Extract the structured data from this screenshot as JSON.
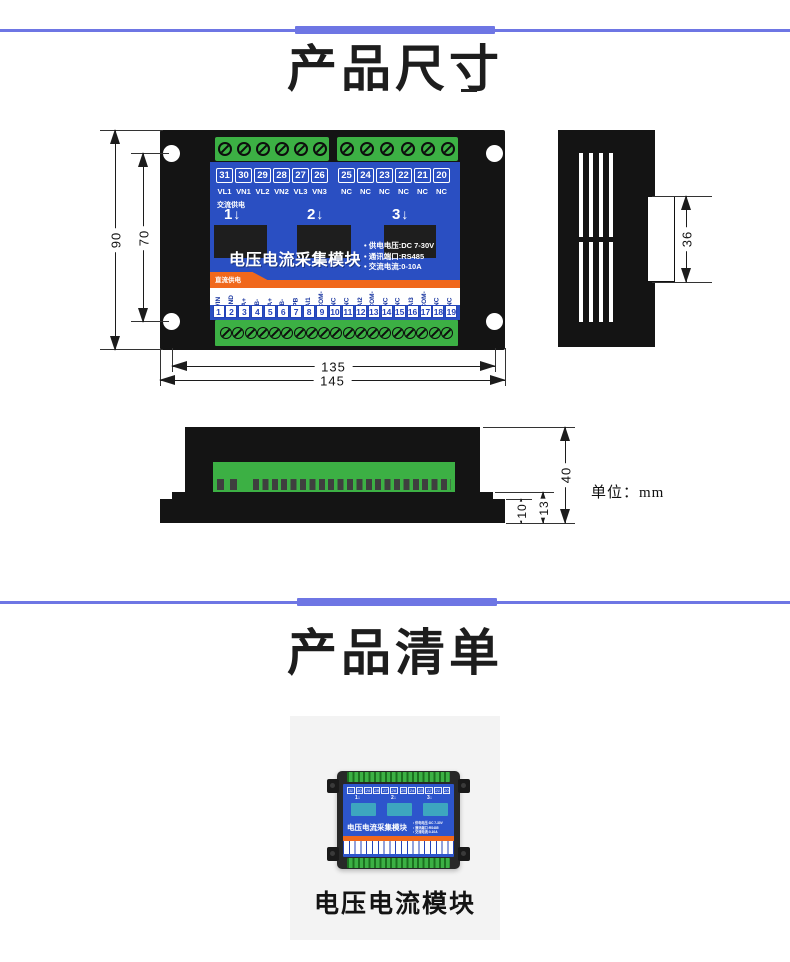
{
  "titles": {
    "dimensions": "产品尺寸",
    "list": "产品清单"
  },
  "unit_label": "单位：mm",
  "dims": {
    "h_outer": "90",
    "h_inner": "70",
    "w_inner": "135",
    "w_outer": "145",
    "side": "36",
    "f_total": "40",
    "f_mid": "13",
    "f_base": "10"
  },
  "module": {
    "product_title": "电压电流采集模块",
    "specs": [
      "• 供电电压:DC 7-30V",
      "• 通讯端口:RS485",
      "• 交流电流:0-10A"
    ],
    "ac_label": "交流供电",
    "dc_label": "直流供电",
    "channels": [
      {
        "n": "1",
        "arrow": "↓"
      },
      {
        "n": "2",
        "arrow": "↓"
      },
      {
        "n": "3",
        "arrow": "↓"
      }
    ],
    "top_group1": [
      {
        "num": "31",
        "label": "VL1"
      },
      {
        "num": "30",
        "label": "VN1"
      },
      {
        "num": "29",
        "label": "VL2"
      },
      {
        "num": "28",
        "label": "VN2"
      },
      {
        "num": "27",
        "label": "VL3"
      },
      {
        "num": "26",
        "label": "VN3"
      }
    ],
    "top_group2": [
      {
        "num": "25",
        "label": "NC"
      },
      {
        "num": "24",
        "label": "NC"
      },
      {
        "num": "23",
        "label": "NC"
      },
      {
        "num": "22",
        "label": "NC"
      },
      {
        "num": "21",
        "label": "NC"
      },
      {
        "num": "20",
        "label": "NC"
      }
    ],
    "bottom_terminals": [
      {
        "num": "1",
        "label": "VIN"
      },
      {
        "num": "2",
        "label": "GND"
      },
      {
        "num": "3",
        "label": "A+"
      },
      {
        "num": "4",
        "label": "B-"
      },
      {
        "num": "5",
        "label": "A+"
      },
      {
        "num": "6",
        "label": "B-"
      },
      {
        "num": "7",
        "label": "PB"
      },
      {
        "num": "8",
        "label": "AI1"
      },
      {
        "num": "9",
        "label": "ACOM-"
      },
      {
        "num": "10",
        "label": "NC"
      },
      {
        "num": "11",
        "label": "NC"
      },
      {
        "num": "12",
        "label": "AI2"
      },
      {
        "num": "13",
        "label": "ACOM-"
      },
      {
        "num": "14",
        "label": "NC"
      },
      {
        "num": "15",
        "label": "NC"
      },
      {
        "num": "16",
        "label": "AI3"
      },
      {
        "num": "17",
        "label": "ACOM-"
      },
      {
        "num": "18",
        "label": "NC"
      },
      {
        "num": "19",
        "label": "NC"
      }
    ]
  },
  "card": {
    "caption": "电压电流模块"
  },
  "colors": {
    "accent": "#6e76e4",
    "blue": "#2a4fc2",
    "green": "#3cb044",
    "orange": "#f0681c",
    "teal": "#3da6bf",
    "case": "#141414",
    "card_bg": "#f3f3f3"
  }
}
